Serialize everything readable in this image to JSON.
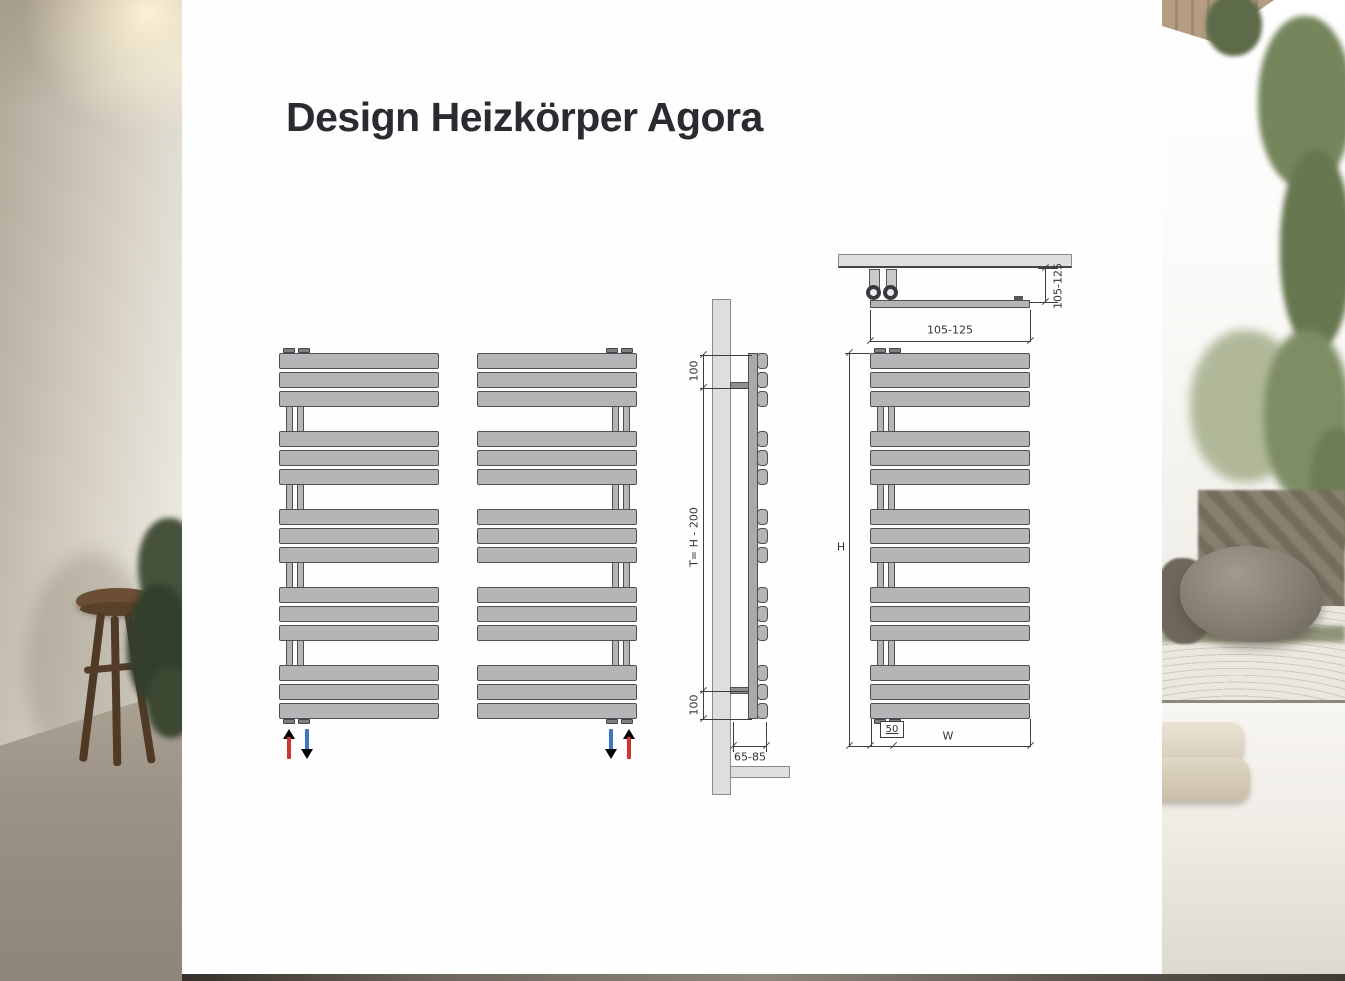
{
  "header": {
    "title": "Design Heizkörper Agora"
  },
  "colors": {
    "radiator_fill": "#b5b5b7",
    "radiator_outline": "#4f4f54",
    "flow_supply_red": "#cf3630",
    "flow_return_blue": "#3c79c4",
    "dimension_line": "#3d3d3d",
    "panel_background": "#fefefe"
  },
  "front_views": {
    "left_unit_flow": [
      "supply-up-red",
      "return-down-blue"
    ],
    "right_unit_flow": [
      "return-down-blue",
      "supply-up-red"
    ]
  },
  "side_view": {
    "dim_top_offset": "100",
    "dim_bracket_span": "T= H - 200",
    "dim_bottom_offset": "100",
    "dim_wall_clearance": "65-85"
  },
  "dimension_view": {
    "dim_depth": "105-125",
    "dim_top_width": "105-125",
    "dim_height": "H",
    "dim_connection_spacing": "50",
    "dim_total_width": "W"
  }
}
